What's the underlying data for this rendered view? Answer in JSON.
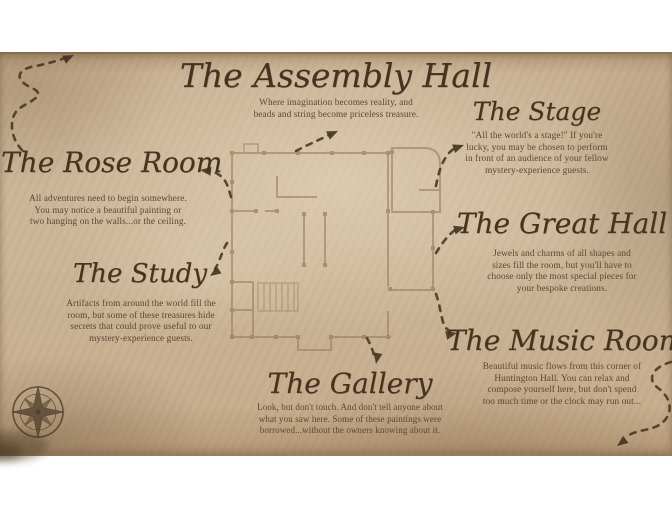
{
  "colors": {
    "paper_white": "#ffffff",
    "parchment": "#c9b194",
    "ink": "#46321f",
    "body_text": "#5d4634",
    "plan_line": "#9b7f5e",
    "trail": "#453523"
  },
  "icons": {
    "compass_rose": "compass-rose",
    "arrowhead": "triangle"
  },
  "rooms": [
    {
      "id": "assembly-hall",
      "title": "The Assembly Hall",
      "lines": [
        "Where imagination becomes reality, and",
        "beads and string become priceless treasure."
      ]
    },
    {
      "id": "stage",
      "title": "The Stage",
      "lines": [
        "\"All the world's a stage!\" If you're",
        "lucky, you may be chosen to perform",
        "in front of an audience of your fellow",
        "mystery-experience guests."
      ]
    },
    {
      "id": "rose-room",
      "title": "The Rose Room",
      "lines": [
        "All adventures need to begin somewhere.",
        "You may notice a beautiful painting or",
        "two hanging on the walls...or the ceiling."
      ]
    },
    {
      "id": "study",
      "title": "The Study",
      "lines": [
        "Artifacts from around the world fill the",
        "room, but some of these treasures hide",
        "secrets that could prove useful to our",
        "mystery-experience guests."
      ]
    },
    {
      "id": "great-hall",
      "title": "The Great Hall",
      "lines": [
        "Jewels and charms of all shapes and",
        "sizes fill the room, but you'll have to",
        "choose only the most special pieces for",
        "your bespoke creations."
      ]
    },
    {
      "id": "music-room",
      "title": "The Music Room",
      "lines": [
        "Beautiful music flows from this corner of",
        "Huntington Hall. You can relax and",
        "compose yourself here, but don't spend",
        "too much time or the clock may run out..."
      ]
    },
    {
      "id": "gallery",
      "title": "The Gallery",
      "lines": [
        "Look, but don't touch. And don't tell anyone about",
        "what you saw here. Some of these paintings were",
        "borrowed...without the owners knowing about it."
      ]
    }
  ]
}
